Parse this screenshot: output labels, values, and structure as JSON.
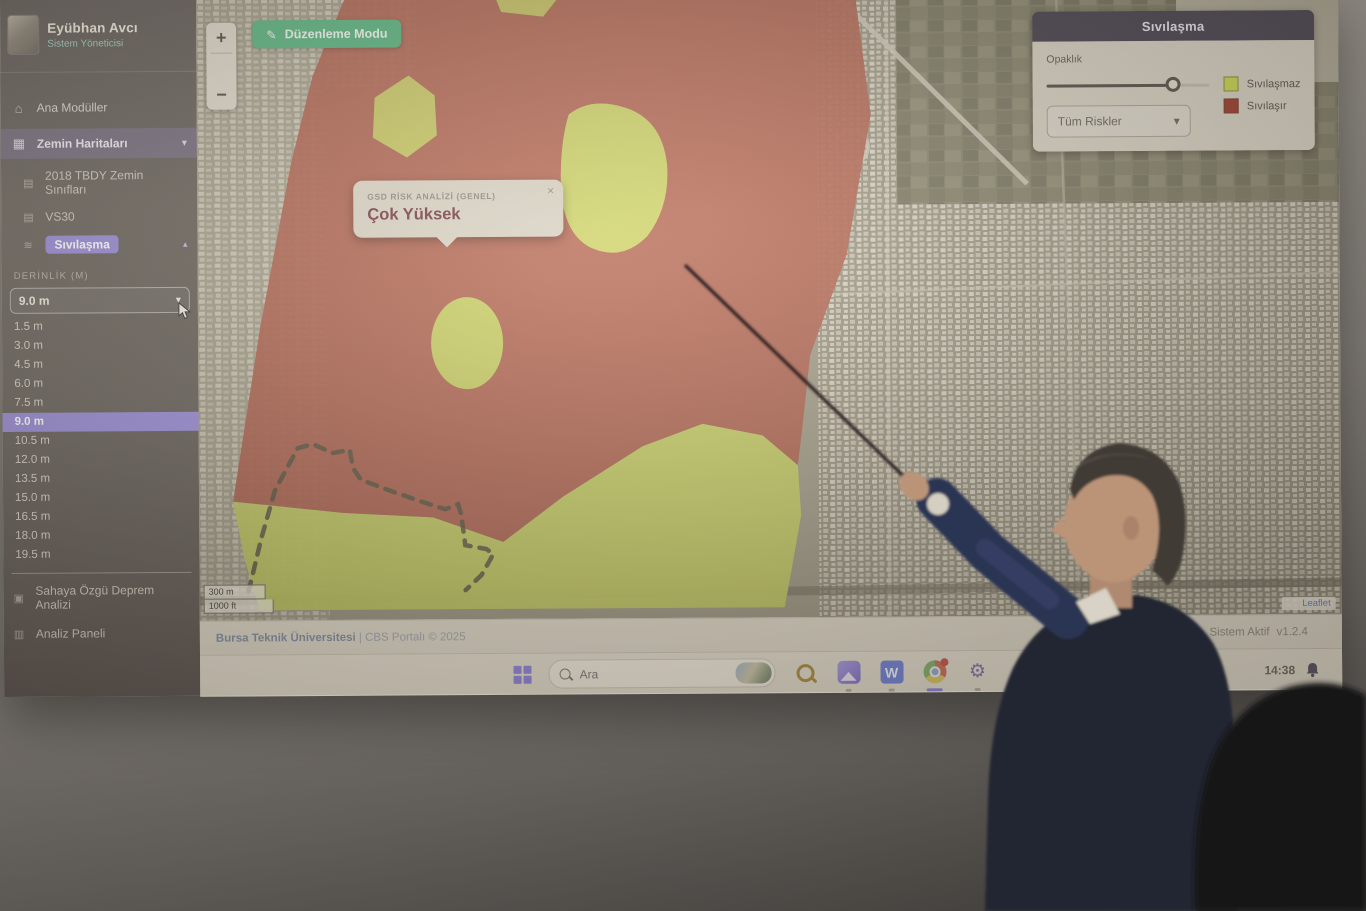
{
  "sidebar": {
    "user": {
      "name": "Eyübhan Avcı",
      "role": "Sistem Yöneticisi"
    },
    "nav": [
      {
        "label": "Ana Modüller"
      },
      {
        "label": "Zemin Haritaları"
      }
    ],
    "sub_nav": [
      {
        "label": "2018 TBDY Zemin Sınıfları"
      },
      {
        "label": "VS30"
      },
      {
        "label": "Sıvılaşma"
      }
    ],
    "depth": {
      "label": "DERİNLİK (M)",
      "selected": "9.0 m",
      "options": [
        "1.5 m",
        "3.0 m",
        "4.5 m",
        "6.0 m",
        "7.5 m",
        "9.0 m",
        "10.5 m",
        "12.0 m",
        "13.5 m",
        "15.0 m",
        "16.5 m",
        "18.0 m",
        "19.5 m"
      ]
    },
    "bottom_nav": [
      {
        "label": "Sahaya Özgü Deprem Analizi"
      },
      {
        "label": "Analiz Paneli"
      }
    ]
  },
  "map": {
    "edit_button_label": "Düzenleme Modu",
    "zoom_in": "+",
    "zoom_out": "−",
    "popup": {
      "title": "GSD RİSK ANALİZİ (GENEL)",
      "value": "Çok Yüksek",
      "close": "×"
    },
    "risk_panel": {
      "title": "Sıvılaşma",
      "opacity_label": "Opaklık",
      "filter_value": "Tüm Riskler",
      "legend": [
        {
          "label": "Sıvılaşmaz",
          "color": "#c9d94f"
        },
        {
          "label": "Sıvılaşır",
          "color": "#9c3a2d"
        }
      ]
    },
    "scale_metric": "300 m",
    "scale_imperial": "1000 ft",
    "leaflet_label": "Leaflet"
  },
  "footer": {
    "attribution_strong": "Bursa Teknik Üniversitesi",
    "attribution_rest": " | CBS Portalı © 2025",
    "status_label": "Sistem Aktif",
    "version": "v1.2.4"
  },
  "taskbar": {
    "search_placeholder": "Ara",
    "clock": "14:38"
  },
  "icons": {
    "edit": "✎",
    "home": "⌂",
    "layers": "▦",
    "doc": "▤",
    "wave": "≋",
    "chart": "▣",
    "panel": "▥",
    "chevron_down": "▾",
    "chevron_up": "▴",
    "word_w": "W",
    "gear": "⚙"
  },
  "colors": {
    "risk_red": "#b65847",
    "risk_yellow": "#d0dd60",
    "accent_purple": "#9a8ed8",
    "accent_green": "#5db584"
  }
}
